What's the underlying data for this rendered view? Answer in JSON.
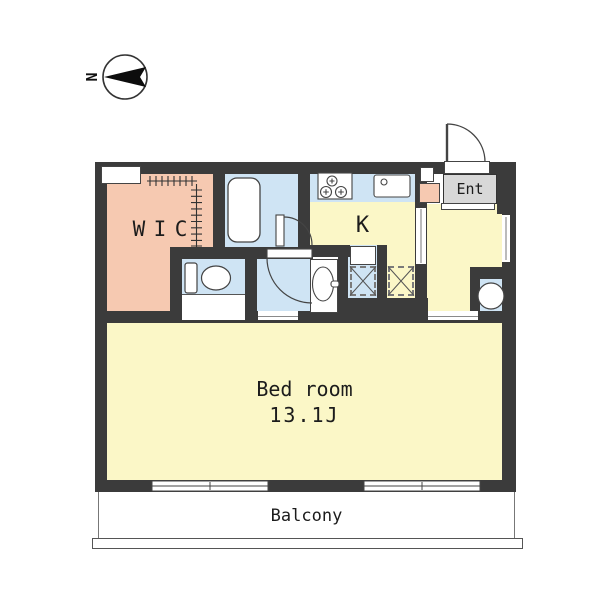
{
  "compass": {
    "north_label": "N"
  },
  "rooms": {
    "wic": "WIC",
    "kitchen": "K",
    "entrance": "Ent",
    "bedroom_name": "Bed room",
    "bedroom_size": "13.1J",
    "balcony": "Balcony"
  },
  "fixtures": {
    "bathtub": "rounded-rect-outline",
    "toilet": "tank-and-bowl",
    "washbasin": "oval-with-tap",
    "gas-stove": "box-with-3-burner-circles",
    "kitchen-sink": "box-with-drain-circle",
    "washer-space": "dashed-box-x",
    "fridge-space": "dashed-box-x",
    "entrance-door": "quarter-arc-swing",
    "bath-door": "quarter-arc-swing",
    "washroom-door": "quarter-arc-swing",
    "wic-hanger-rod": "tick-marked-rail",
    "compass": "circle-with-needle"
  },
  "colors": {
    "wall": "#3b3b3b",
    "room-yellow": "#fbf7c7",
    "room-blue": "#cfe4f4",
    "room-pink": "#f6c9b1",
    "entrance-gray": "#d8d8d8",
    "line": "#444444",
    "bg": "#ffffff"
  }
}
